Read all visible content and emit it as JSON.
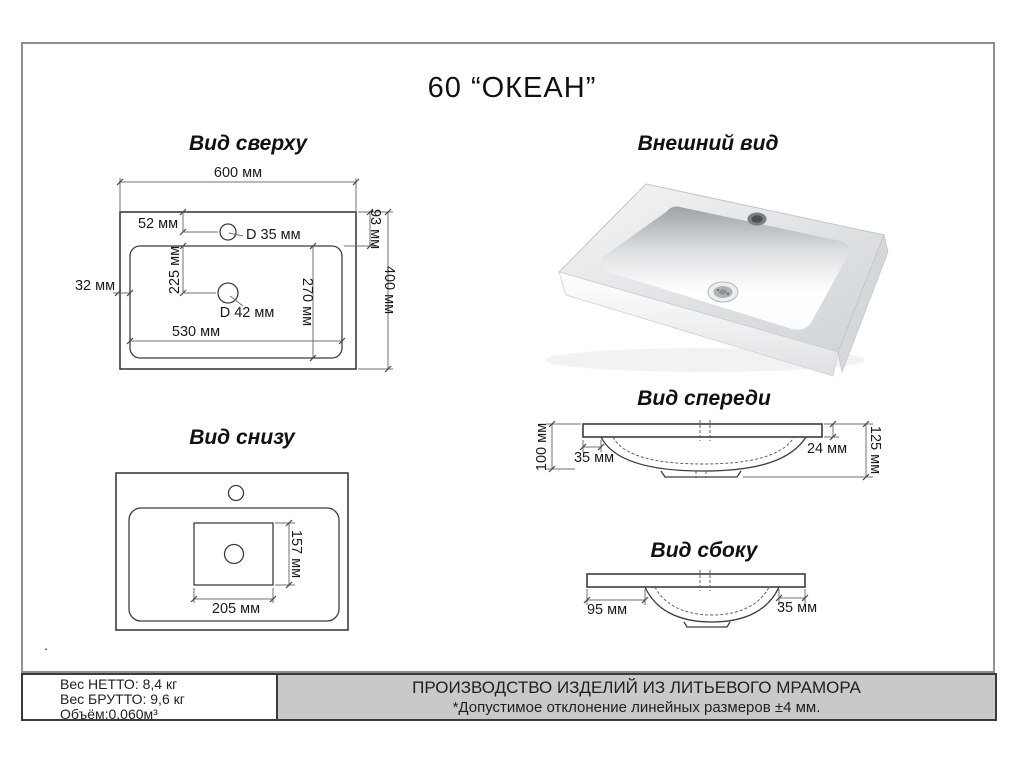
{
  "title": "60 “ОКЕАН”",
  "views": {
    "top": {
      "title": "Вид сверху",
      "dims": {
        "w600": "600 мм",
        "off52": "52 мм",
        "d35": "D 35 мм",
        "h93": "93 мм",
        "left32": "32 мм",
        "v225": "225 мм",
        "d42": "D 42 мм",
        "v270": "270 мм",
        "w530": "530 мм",
        "h400": "400 мм"
      }
    },
    "external": {
      "title": "Внешний вид"
    },
    "bottom": {
      "title": "Вид снизу",
      "dims": {
        "h157": "157 мм",
        "w205": "205 мм"
      }
    },
    "front": {
      "title": "Вид спереди",
      "dims": {
        "h100": "100 мм",
        "inset35": "35 мм",
        "rim24": "24 мм",
        "h125": "125 мм"
      }
    },
    "side": {
      "title": "Вид сбоку",
      "dims": {
        "inset95": "95 мм",
        "inset35": "35 мм"
      }
    }
  },
  "footer": {
    "net": "Вес НЕТТО: 8,4 кг",
    "gross": "Вес БРУТТО: 9,6 кг",
    "volume": "Объём:0,060м³",
    "note1": "ПРОИЗВОДСТВО ИЗДЕЛИЙ ИЗ ЛИТЬЕВОГО МРАМОРА",
    "note2": "*Допустимое отклонение линейных размеров ±4 мм.",
    "stray_dot": "."
  },
  "colors": {
    "line": "#3c3c3c",
    "dim_line": "#707070",
    "footer_bg": "#c9c9c9",
    "page_border": "#8f8f8f"
  }
}
